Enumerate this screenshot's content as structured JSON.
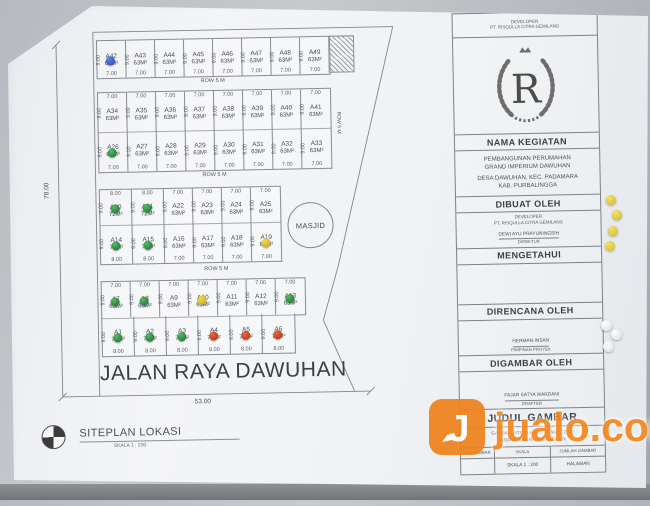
{
  "plan": {
    "dim_height": "78.00",
    "dim_width": "53.00",
    "road_name": "JALAN RAYA DAWUHAN",
    "row_spacing_label": "ROW 5 M",
    "masjid_label": "MASJID",
    "rows": {
      "r1": {
        "lots": [
          {
            "id": "A42",
            "area": "63M²",
            "w": "7.00",
            "h": "9.00",
            "dot": "blue"
          },
          {
            "id": "A43",
            "area": "63M²",
            "w": "7.00",
            "h": "9.00"
          },
          {
            "id": "A44",
            "area": "63M²",
            "w": "7.00",
            "h": "9.00"
          },
          {
            "id": "A45",
            "area": "63M²",
            "w": "7.00",
            "h": "9.00"
          },
          {
            "id": "A46",
            "area": "63M²",
            "w": "7.00",
            "h": "9.00"
          },
          {
            "id": "A47",
            "area": "63M²",
            "w": "7.00",
            "h": "9.00"
          },
          {
            "id": "A48",
            "area": "63M²",
            "w": "7.00",
            "h": "9.00"
          },
          {
            "id": "A49",
            "area": "63M²",
            "w": "7.00",
            "h": "9.00"
          }
        ]
      },
      "r2": {
        "lots": [
          {
            "id": "A34",
            "area": "63M²",
            "w": "7.00",
            "h": "9.00"
          },
          {
            "id": "A35",
            "area": "63M²",
            "w": "7.00",
            "h": "9.00"
          },
          {
            "id": "A36",
            "area": "63M²",
            "w": "7.00",
            "h": "9.00"
          },
          {
            "id": "A37",
            "area": "63M²",
            "w": "7.00",
            "h": "9.00"
          },
          {
            "id": "A38",
            "area": "63M²",
            "w": "7.00",
            "h": "9.00"
          },
          {
            "id": "A39",
            "area": "63M²",
            "w": "7.00",
            "h": "9.00"
          },
          {
            "id": "A40",
            "area": "63M²",
            "w": "7.00",
            "h": "9.00"
          },
          {
            "id": "A41",
            "area": "63M²",
            "w": "7.00",
            "h": "9.00"
          }
        ]
      },
      "r3": {
        "lots": [
          {
            "id": "A26",
            "area": "63M²",
            "w": "7.00",
            "h": "9.00",
            "dot": "green"
          },
          {
            "id": "A27",
            "area": "63M²",
            "w": "7.00",
            "h": "9.00"
          },
          {
            "id": "A28",
            "area": "63M²",
            "w": "7.00",
            "h": "9.00"
          },
          {
            "id": "A29",
            "area": "63M²",
            "w": "7.00",
            "h": "9.00"
          },
          {
            "id": "A30",
            "area": "63M²",
            "w": "7.00",
            "h": "9.00"
          },
          {
            "id": "A31",
            "area": "63M²",
            "w": "7.00",
            "h": "9.00"
          },
          {
            "id": "A32",
            "area": "63M²",
            "w": "7.00",
            "h": "9.00"
          },
          {
            "id": "A33",
            "area": "63M²",
            "w": "7.00",
            "h": "9.00"
          }
        ]
      },
      "r4": {
        "lots": [
          {
            "id": "A20",
            "area": "72M²",
            "w": "8.00",
            "h": "9.00",
            "dot": "green"
          },
          {
            "id": "A21",
            "area": "72M²",
            "w": "8.00",
            "h": "9.00",
            "dot": "green"
          },
          {
            "id": "A22",
            "area": "63M²",
            "w": "7.00",
            "h": "9.00"
          },
          {
            "id": "A23",
            "area": "63M²",
            "w": "7.00",
            "h": "9.00"
          },
          {
            "id": "A24",
            "area": "63M²",
            "w": "7.00",
            "h": "9.00"
          },
          {
            "id": "A25",
            "area": "63M²",
            "w": "7.00",
            "h": "9.00"
          }
        ]
      },
      "r5": {
        "lots": [
          {
            "id": "A14",
            "area": "72M²",
            "w": "8.00",
            "h": "9.00",
            "dot": "green"
          },
          {
            "id": "A15",
            "area": "72M²",
            "w": "8.00",
            "h": "9.00",
            "dot": "green"
          },
          {
            "id": "A16",
            "area": "63M²",
            "w": "7.00",
            "h": "9.00"
          },
          {
            "id": "A17",
            "area": "63M²",
            "w": "7.00",
            "h": "9.00"
          },
          {
            "id": "A18",
            "area": "63M²",
            "w": "7.00",
            "h": "9.00"
          },
          {
            "id": "A19",
            "area": "63M²",
            "w": "7.00",
            "h": "9.00",
            "dot": "yellow"
          }
        ]
      },
      "r6": {
        "lots": [
          {
            "id": "A7",
            "area": "63M²",
            "w": "7.00",
            "h": "9.00",
            "dot": "green"
          },
          {
            "id": "A8",
            "area": "63M²",
            "w": "7.00",
            "h": "9.00",
            "dot": "green"
          },
          {
            "id": "A9",
            "area": "63M²",
            "w": "7.00",
            "h": "9.00"
          },
          {
            "id": "A10",
            "area": "63M²",
            "w": "7.00",
            "h": "9.00",
            "dot": "yellow"
          },
          {
            "id": "A11",
            "area": "63M²",
            "w": "7.00",
            "h": "9.00"
          },
          {
            "id": "A12",
            "area": "63M²",
            "w": "7.00",
            "h": "9.00"
          },
          {
            "id": "A13",
            "area": "63M²",
            "w": "7.00",
            "h": "9.00",
            "dot": "green"
          }
        ]
      },
      "r7": {
        "lots": [
          {
            "id": "A1",
            "area": "72M²",
            "w": "8.00",
            "h": "9.00",
            "dot": "green"
          },
          {
            "id": "A2",
            "area": "72M²",
            "w": "8.00",
            "h": "9.00",
            "dot": "green"
          },
          {
            "id": "A3",
            "area": "72M²",
            "w": "8.00",
            "h": "9.00",
            "dot": "green"
          },
          {
            "id": "A4",
            "area": "72M²",
            "w": "8.00",
            "h": "9.00",
            "dot": "red"
          },
          {
            "id": "A5",
            "area": "72M²",
            "w": "8.00",
            "h": "9.00",
            "dot": "red"
          },
          {
            "id": "A6",
            "area": "72M²",
            "w": "8.00",
            "h": "9.00",
            "dot": "red"
          }
        ]
      }
    }
  },
  "legend": {
    "label": "SITEPLAN LOKASI",
    "scale": "SKALA 1 : 200"
  },
  "titleblock": {
    "header_small_1": "DEVELOPER",
    "header_small_2": "PT. RISQULLA CITRA GEMILANG",
    "logo_letter": "R",
    "nama_kegiatan_label": "NAMA KEGIATAN",
    "kegiatan_line1": "PEMBANGUNAN PERUMAHAN",
    "kegiatan_line2": "GRAND IMPERIUM DAWUHAN",
    "lokasi_line1": "DESA DAWUHAN, KEC. PADAMARA",
    "lokasi_line2": "KAB. PURBALINGGA",
    "dibuat_label": "DIBUAT OLEH",
    "dibuat_small1": "DEVELOPER",
    "dibuat_small2": "PT. RISQULLA CITRA GEMILANG",
    "dibuat_name": "DEWI AYU PRAYUNINGSIH",
    "dibuat_role": "DIREKTUR",
    "mengetahui_label": "MENGETAHUI",
    "direncana_label": "DIRENCANA OLEH",
    "direncana_name": "HERMAN INSAN",
    "direncana_role": "PIMPINAN PROYEK",
    "digambar_label": "DIGAMBAR OLEH",
    "digambar_name": "FAJAR SATYA WARDANI",
    "digambar_role": "DRAFTER",
    "judul_label": "JUDUL GAMBAR",
    "judul_line1": "GAMBAR SITE PLAN LT. 63 M2 / 72 M2",
    "judul_line2": "GRAND IMPERIUM DAWUHAN",
    "table_headers": [
      "NO. LEMBAR",
      "SKALA",
      "JUMLAH GAMBAR"
    ],
    "table_values": [
      "",
      "SKALA 1 : 200",
      "HALAMAN"
    ]
  },
  "watermark": {
    "text": "jualo.com"
  }
}
